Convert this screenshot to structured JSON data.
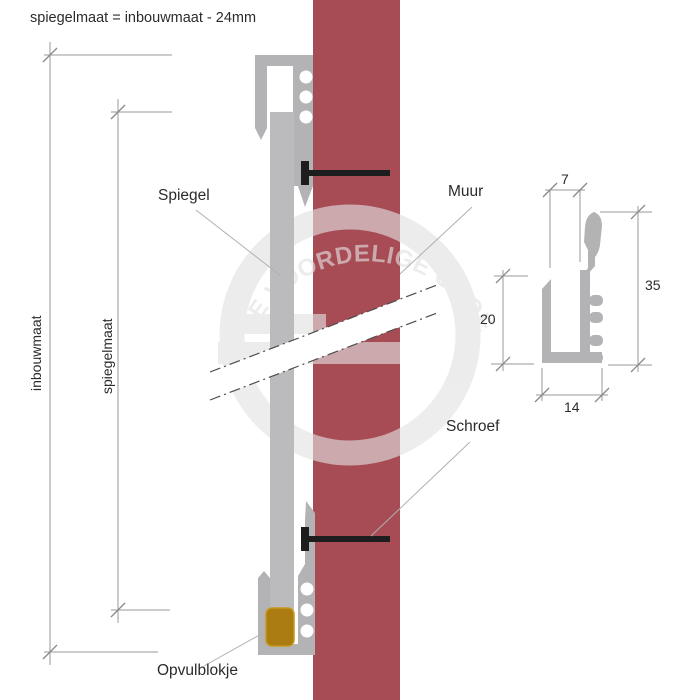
{
  "page": {
    "title": "spiegelmaat = inbouwmaat - 24mm"
  },
  "diagram": {
    "labels": {
      "spiegel": "Spiegel",
      "muur": "Muur",
      "schroef": "Schroef",
      "opvulblokje": "Opvulblokje"
    },
    "dimension_labels": {
      "inbouwmaat": "inbouwmaat",
      "spiegelmaat": "spiegelmaat"
    },
    "profile_detail": {
      "top_width_mm": "7",
      "inner_height_mm": "20",
      "total_height_mm": "35",
      "bottom_width_mm": "14"
    }
  },
  "watermark": {
    "text": "DE VOORDELIGE GROEP"
  },
  "colors": {
    "wall": "#a74c55",
    "profile": "#b3b3b5",
    "mirror": "#bbbbbd",
    "filler_block": "#ab7c12",
    "filler_block_border": "#c79a1a",
    "screw": "#1d1d1d",
    "dimension_line": "#9a9a9a",
    "leader_line": "#b0b0b0",
    "text": "#2b2b2b",
    "watermark": "#e2e2e2",
    "break_edge": "#4d4d4d"
  }
}
